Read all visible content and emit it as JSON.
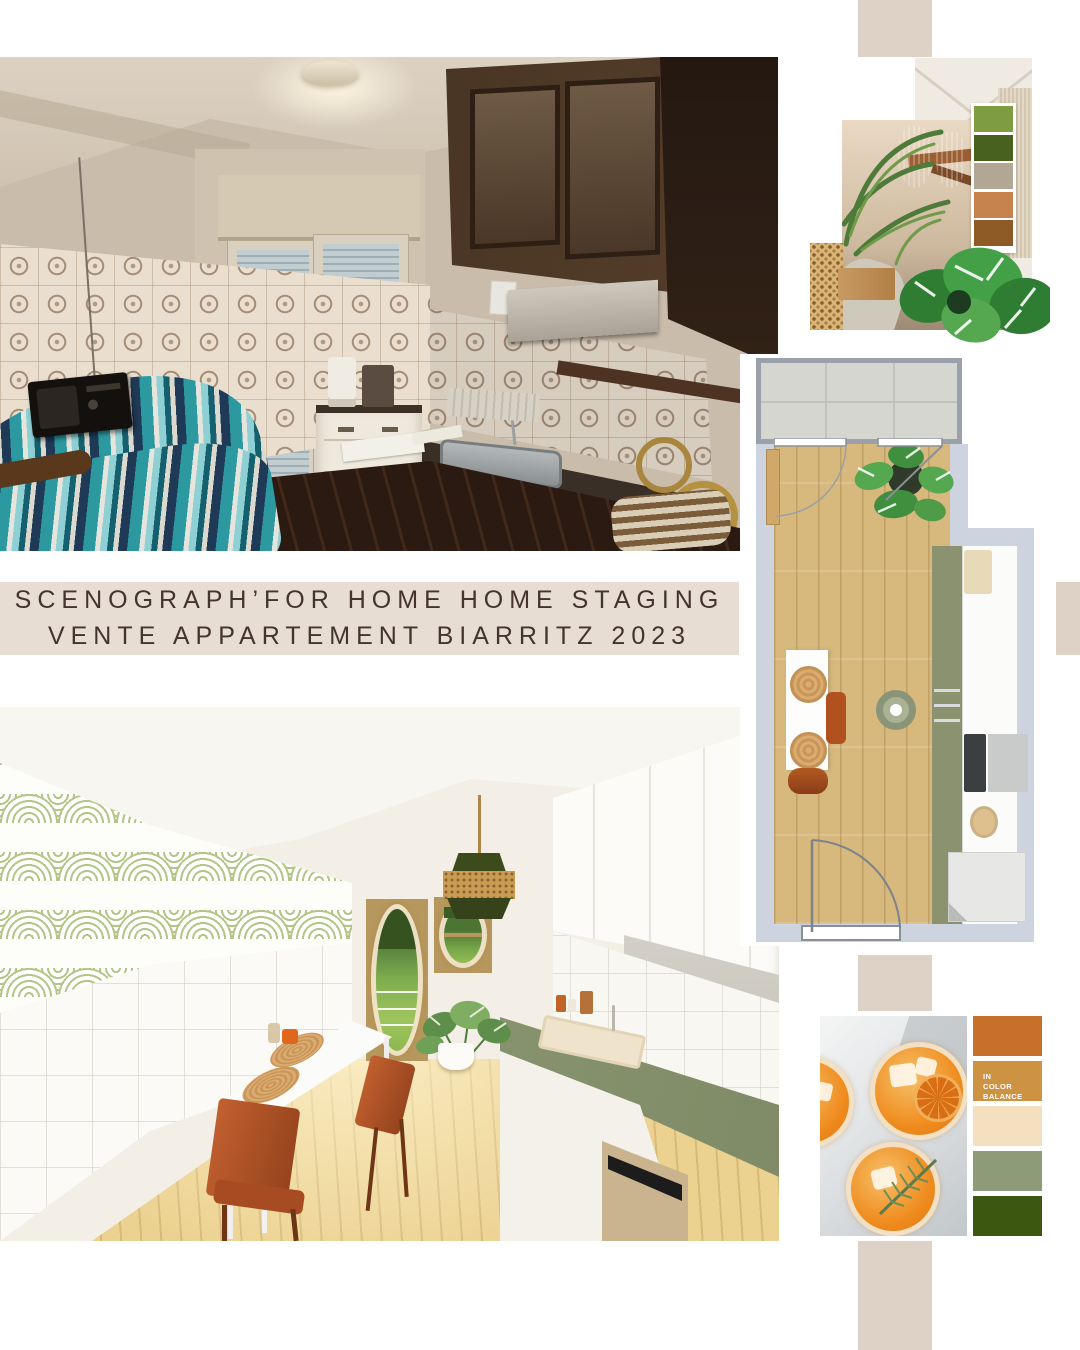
{
  "banner": {
    "line1": "SCENOGRAPH’FOR HOME HOME STAGING",
    "line2": "VENTE APPARTEMENT BIARRITZ 2023"
  },
  "moodboard": {
    "palette": [
      "#7E9D40",
      "#48611F",
      "#B2A794",
      "#C6834D",
      "#8E5A26"
    ]
  },
  "color_balance": {
    "label_lines": [
      "IN",
      "COLOR",
      "BALANCE"
    ],
    "palette": [
      "#C77029",
      "#CE9342",
      "#F4E0BF",
      "#8E9B78",
      "#3C570F"
    ]
  },
  "theme": {
    "banner_bg": "#E7DDD3",
    "banner_text": "#44332E",
    "block_beige": "#DDD2C5",
    "plan_wall": "#CDD4E0",
    "counter_green": "#8A9270",
    "chair_rust": "#B0511F",
    "floor_wood": "#D7B87D"
  }
}
